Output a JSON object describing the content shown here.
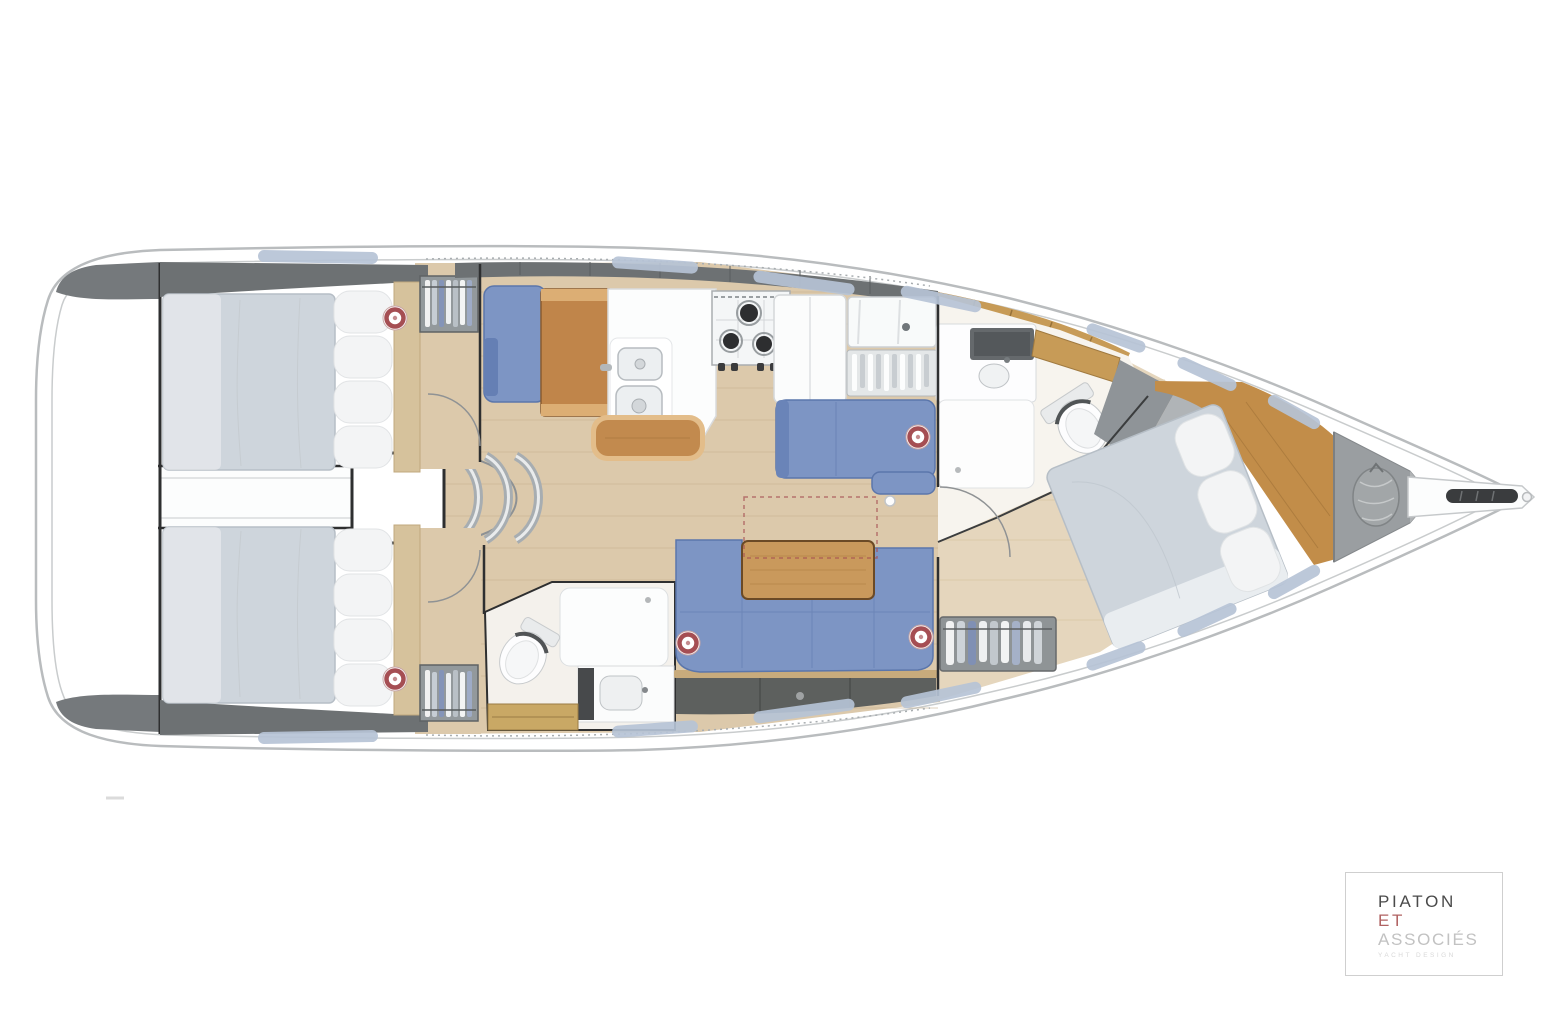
{
  "logo": {
    "line1": "PIATON",
    "line2": "ET",
    "line3": "ASSOCIÉS",
    "tagline": "YACHT DESIGN"
  },
  "palette": {
    "hull-stroke": "#b9bcbe",
    "sheer-line": "#c9cccd",
    "deck-white": "#ffffff",
    "bulwark-gray": "#75797c",
    "cabinet-dark": "#6d7173",
    "cabinet-seam": "#595d5f",
    "locker-dark": "#5d605e",
    "window-blue": "#b7c3d6",
    "floor-wood": "#dcc9ab",
    "floor-plank": "#cbb591",
    "floor-fwd": "#e5d6bd",
    "table-wood": "#c0854a",
    "table-trim": "#dcae74",
    "bench-wood": "#c28a4e",
    "bench-trim": "#e3bd8a",
    "salon-table": "#c9995c",
    "fabric-blue": "#7d95c4",
    "fabric-blue-dark": "#5b76ab",
    "fabric-seam": "#6a84b6",
    "mattress-gray": "#ced5dc",
    "mattress-stroke": "#b6bec6",
    "pillow-white": "#f3f4f5",
    "fixture-white": "#fdfdfe",
    "fixture-stroke": "#d7dadc",
    "steel-gray": "#a7adb1",
    "wood-band": "#c79b57",
    "wood-seam": "#97723a",
    "fwd-wood": "#c28d49",
    "bow-locker": "#9a9ea1",
    "sailbag-gray": "#a2a6a8",
    "wall-dark": "#2e2f30",
    "portlight-red": "#a54e53",
    "logo-primary": "#4a4a4a",
    "logo-accent": "#b06262",
    "logo-muted": "#c2c2c2",
    "logo-tagline": "#d8d8d8",
    "logo-border": "#cfcfcf"
  }
}
